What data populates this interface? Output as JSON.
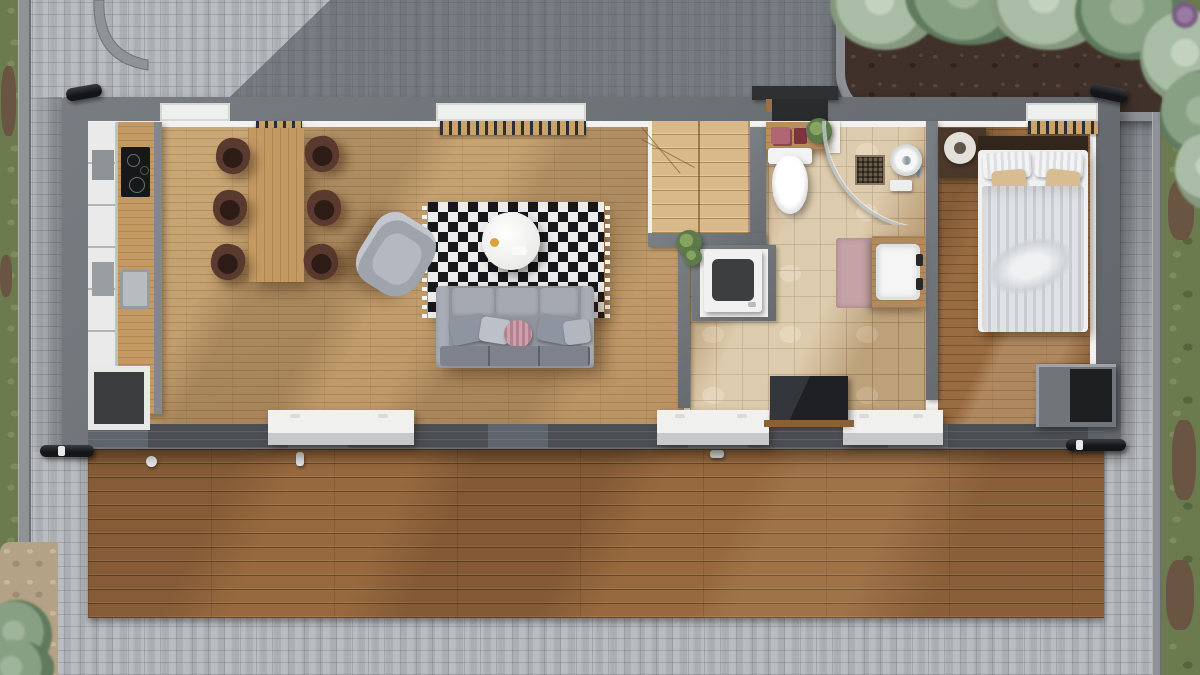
{
  "scene": {
    "type": "3D top-down floor plan render",
    "description": "Single-storey rectangular house with open living/kitchen/dining area, staircase, bathroom, bedroom, full-width wooden deck, cobblestone yard, lawn strips and a shrub garden bed"
  },
  "palette": {
    "cobblestone": "#b4b7bb",
    "cobblestone_shadow": "#596069",
    "curb": "#8f9398",
    "grass": "#6b7b4d",
    "soil": "#40312a",
    "shrub": "#a9bca6",
    "house_wall": "#6e7377",
    "interior_wall": "#f3f2ef",
    "living_floor": "#c3a06e",
    "tile_floor": "#ccb28b",
    "bedroom_floor": "#9a6c41",
    "deck": "#98693e",
    "rug_black": "#17171b",
    "rug_white": "#ededed",
    "sofa_gray": "#8f939c",
    "chair_brown": "#5a392e",
    "accent_pillow_pink": "#b5818f",
    "duvet": "#d7dade",
    "tan_pillow": "#d9bd92",
    "tv_black": "#26282b"
  },
  "exterior": {
    "ground": {
      "label": "cobblestone paving"
    },
    "garden_bed": {
      "label": "garden bed with sage-green shrubs and soil"
    },
    "grass_left": {
      "label": "grass strip along left edge"
    },
    "grass_right": {
      "label": "grass strip along right edge"
    },
    "deck": {
      "label": "wooden terrace deck along south side"
    },
    "pipes": {
      "label": "black roof drainage pipes at house corners"
    }
  },
  "house": {
    "label": "house footprint with dark gray walls",
    "entry": {
      "door_mat": "dark entry mat at north door",
      "canopy": "dark canopy over entry"
    },
    "rooms": {
      "living": {
        "label": "open kitchen / dining / living room",
        "furniture": {
          "kitchen_cabinets": {
            "label": "tall kitchen cabinet run"
          },
          "kitchen_counter": {
            "label": "wooden kitchen counter"
          },
          "cooktop": {
            "label": "black induction cooktop with 4 burners"
          },
          "sink": {
            "label": "kitchen sink"
          },
          "open_cabinet": {
            "label": "open dark base cabinet"
          },
          "dining_table": {
            "label": "wooden dining table for six"
          },
          "dining_chair": {
            "label": "dark brown dining chair"
          },
          "rug": {
            "label": "black and white diamond-pattern rug"
          },
          "coffee_table": {
            "label": "round white coffee table"
          },
          "armchair": {
            "label": "gray armchair"
          },
          "sofa": {
            "label": "three-seat gray sofa with cushions and pink accent pillow"
          },
          "sideboard": {
            "label": "low white sideboard"
          },
          "wall_bench": {
            "label": "slatted bench under window"
          }
        }
      },
      "hall": {
        "label": "entry hall with staircase",
        "furniture": {
          "stairs": {
            "label": "wooden staircase with winders"
          },
          "console": {
            "label": "entry console table with books and plant"
          },
          "washer": {
            "label": "washing machine in niche"
          },
          "tv": {
            "label": "flat TV panel on wooden ledge"
          }
        }
      },
      "bathroom": {
        "label": "bathroom with beige tile floor",
        "furniture": {
          "toilet": {
            "label": "wall-hung toilet"
          },
          "shower": {
            "label": "corner shower with curved glass and rain head"
          },
          "vanity": {
            "label": "wooden vanity with white basin"
          },
          "bath_mat": {
            "label": "dusty-pink bath mat"
          }
        }
      },
      "bedroom": {
        "label": "bedroom",
        "furniture": {
          "bed": {
            "label": "double bed with striped duvet and tan pillows"
          },
          "nightstand": {
            "label": "dark bedside shelf with round lamp"
          },
          "wardrobe": {
            "label": "dark open wardrobe unit"
          }
        }
      }
    }
  }
}
